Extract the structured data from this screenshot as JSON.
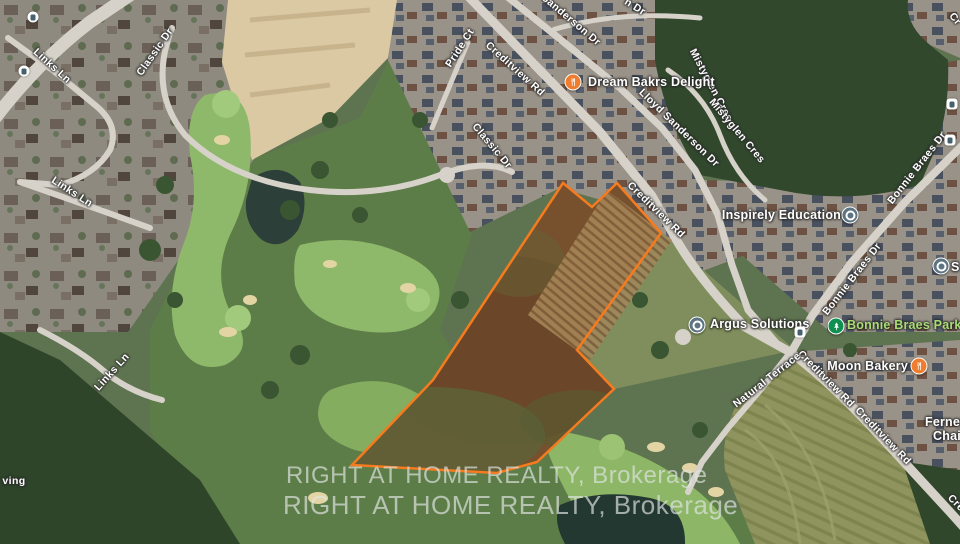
{
  "map": {
    "street_labels": [
      {
        "text": "Links Ln"
      },
      {
        "text": "Links Ln"
      },
      {
        "text": "Links Ln"
      },
      {
        "text": "Classic Dr"
      },
      {
        "text": "Classic Dr"
      },
      {
        "text": "Pride Ct"
      },
      {
        "text": "Creditview Rd"
      },
      {
        "text": "Creditview Rd"
      },
      {
        "text": "Creditview Rd"
      },
      {
        "text": "Creditview Rd"
      },
      {
        "text": "Sanderson Dr"
      },
      {
        "text": "Lloyd Sanderson Dr"
      },
      {
        "text": "Mistyglen Cres"
      },
      {
        "text": "Mistyglen Cres"
      },
      {
        "text": "Bonnie Braes Dr"
      },
      {
        "text": "Bonnie Braes Dr"
      },
      {
        "text": "Natural Terrace"
      },
      {
        "text": "n Dr"
      },
      {
        "text": "Cr"
      },
      {
        "text": "Cre"
      },
      {
        "text": "ving"
      }
    ],
    "businesses": [
      {
        "name": "Dream Bakrs Delight",
        "type": "restaurant"
      },
      {
        "name": "Inspirely Education",
        "type": "business"
      },
      {
        "name": "Argus Solutions",
        "type": "business"
      },
      {
        "name": "Bonnie Braes Park",
        "type": "park"
      },
      {
        "name": "Moon Bakery",
        "type": "restaurant"
      },
      {
        "name": "Fernex C",
        "name2": "Chain",
        "type": "business"
      },
      {
        "name": "S",
        "type": "business"
      }
    ],
    "watermark": {
      "line1": "RIGHT AT HOME REALTY, Brokerage",
      "line2": "RIGHT AT HOME REALTY, Brokerage"
    },
    "icons": {
      "restaurant_pin": "fork-knife",
      "business_pin": "dot-ring",
      "park_pin": "tree",
      "transit_stop": "bus"
    },
    "colors": {
      "boundary": "#f57b1e",
      "park_label": "#a9dc76",
      "restaurant_pin": "#ee7d2f",
      "business_pin": "#5d7482",
      "park_pin": "#0e9150"
    }
  }
}
